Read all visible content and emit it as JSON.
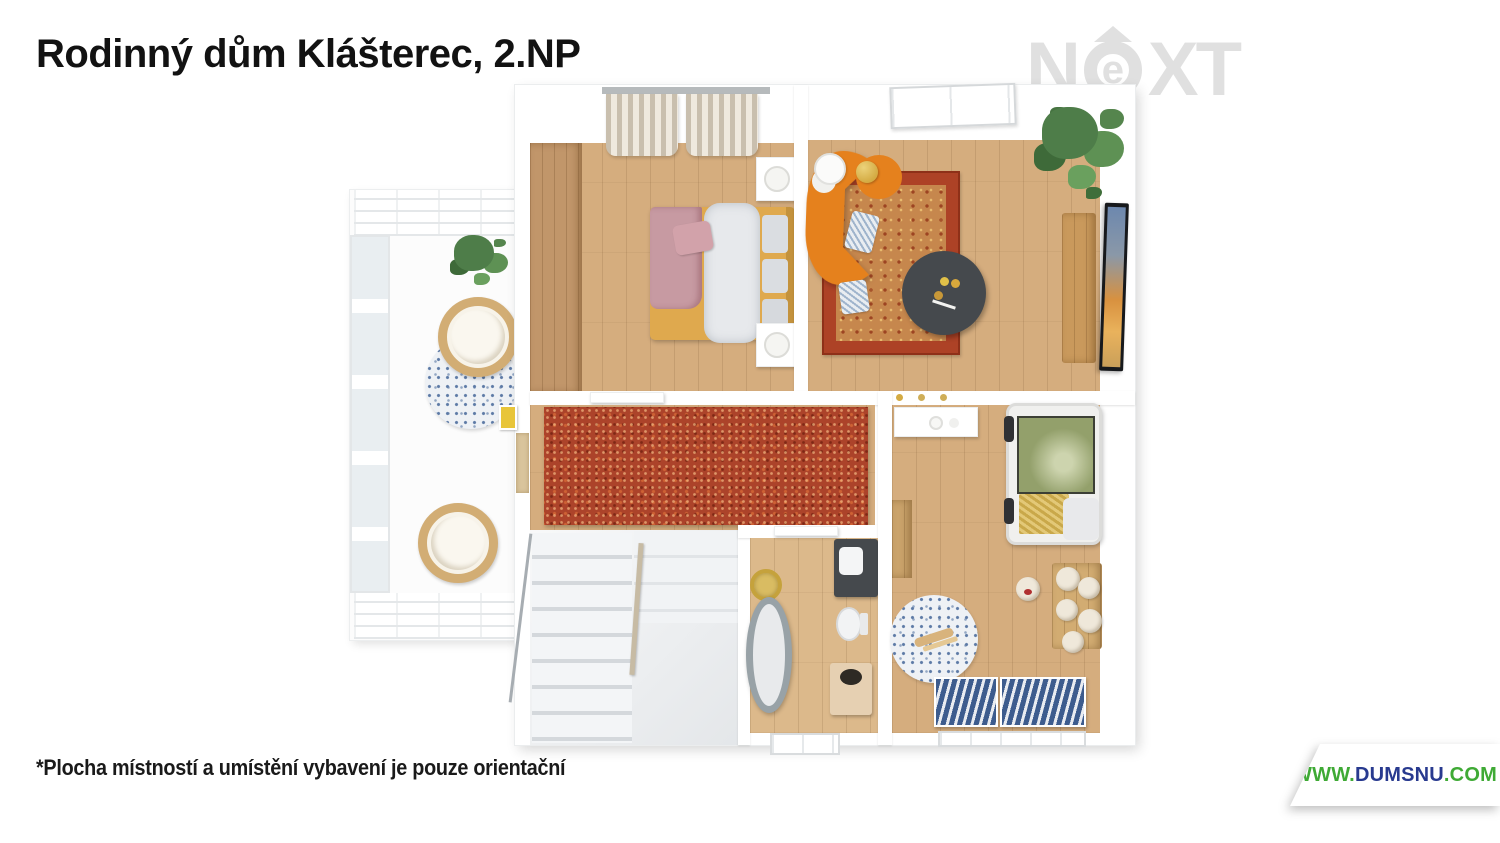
{
  "header": {
    "title": "Rodinný dům Klášterec, 2.NP"
  },
  "watermark": {
    "letter_n": "N",
    "letter_e": "e",
    "letter_x": "X",
    "letter_t": "T"
  },
  "footer": {
    "disclaimer": "*Plocha místností a umístění vybavení je pouze orientační"
  },
  "website": {
    "prefix": "WWW.",
    "name": "DUMSNU",
    "suffix": ".COM"
  },
  "colors": {
    "wood": "#d5ad7e",
    "wood-dark": "#c1966a",
    "wood-light": "#dcb98b",
    "carpet-red": "#ac432a",
    "rug-border": "#ad4226",
    "rug-center": "#c6874d",
    "sofa-orange": "#e5811d",
    "table-dark": "#45494d",
    "marble": "#edeff1",
    "tub-gray": "#98a2a7",
    "canopy-green": "#93a06b",
    "radiator-blue": "#3d5c8e",
    "plant-green": "#4e7d49",
    "blanket-pink": "#c79aa2",
    "gold": "#d4ab43",
    "logo-gray": "#e0e0e0",
    "web-green": "#3faa35",
    "web-navy": "#283a8f"
  }
}
